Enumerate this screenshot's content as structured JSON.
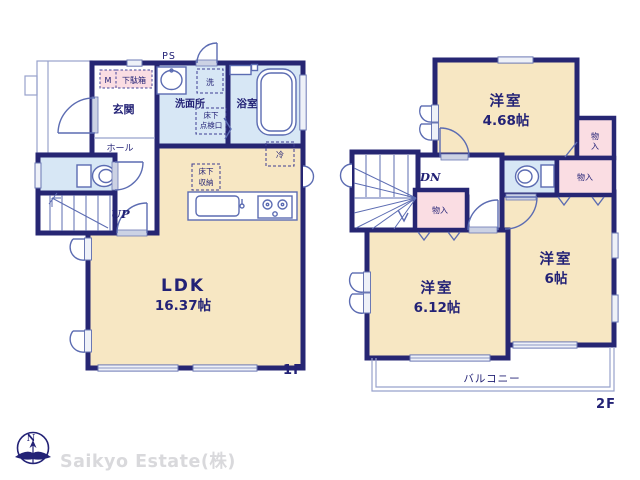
{
  "colors": {
    "wall": "#262673",
    "room_cream": "#f7e7c3",
    "closet_pink": "#fadde3",
    "wet_area_blue": "#d7e7f5",
    "fixture_stroke": "#5c6cb2",
    "label_navy": "#232276",
    "watermark_gray": "#d9d9dc"
  },
  "floor1": {
    "floor_label": "1F",
    "ps_label": "PS",
    "meter_label": "M",
    "shoe_cabinet_label": "下駄箱",
    "entrance_label": "玄関",
    "hall_label": "ホール",
    "washroom_label": "洗面所",
    "washer_label": "洗",
    "floor_hatch_line1": "床下",
    "floor_hatch_line2": "点検口",
    "bathroom_label": "浴室",
    "underfloor_storage_line1": "床下",
    "underfloor_storage_line2": "収納",
    "fridge_label": "冷",
    "stairs_up_label": "UP",
    "ldk_name": "LDK",
    "ldk_area": "16.37帖"
  },
  "floor2": {
    "floor_label": "2F",
    "stairs_down_label": "DN",
    "room_a_name": "洋室",
    "room_a_area": "4.68帖",
    "room_b_name": "洋室",
    "room_b_area": "6.12帖",
    "room_c_name": "洋室",
    "room_c_area": "6帖",
    "closet_top_char1": "物",
    "closet_top_char2": "入",
    "closet_right_label": "物入",
    "closet_bottom_label": "物入",
    "balcony_label": "バルコニー"
  },
  "compass": {
    "north_label": "N"
  },
  "watermark": {
    "company": "Saikyo Estate(株)"
  }
}
